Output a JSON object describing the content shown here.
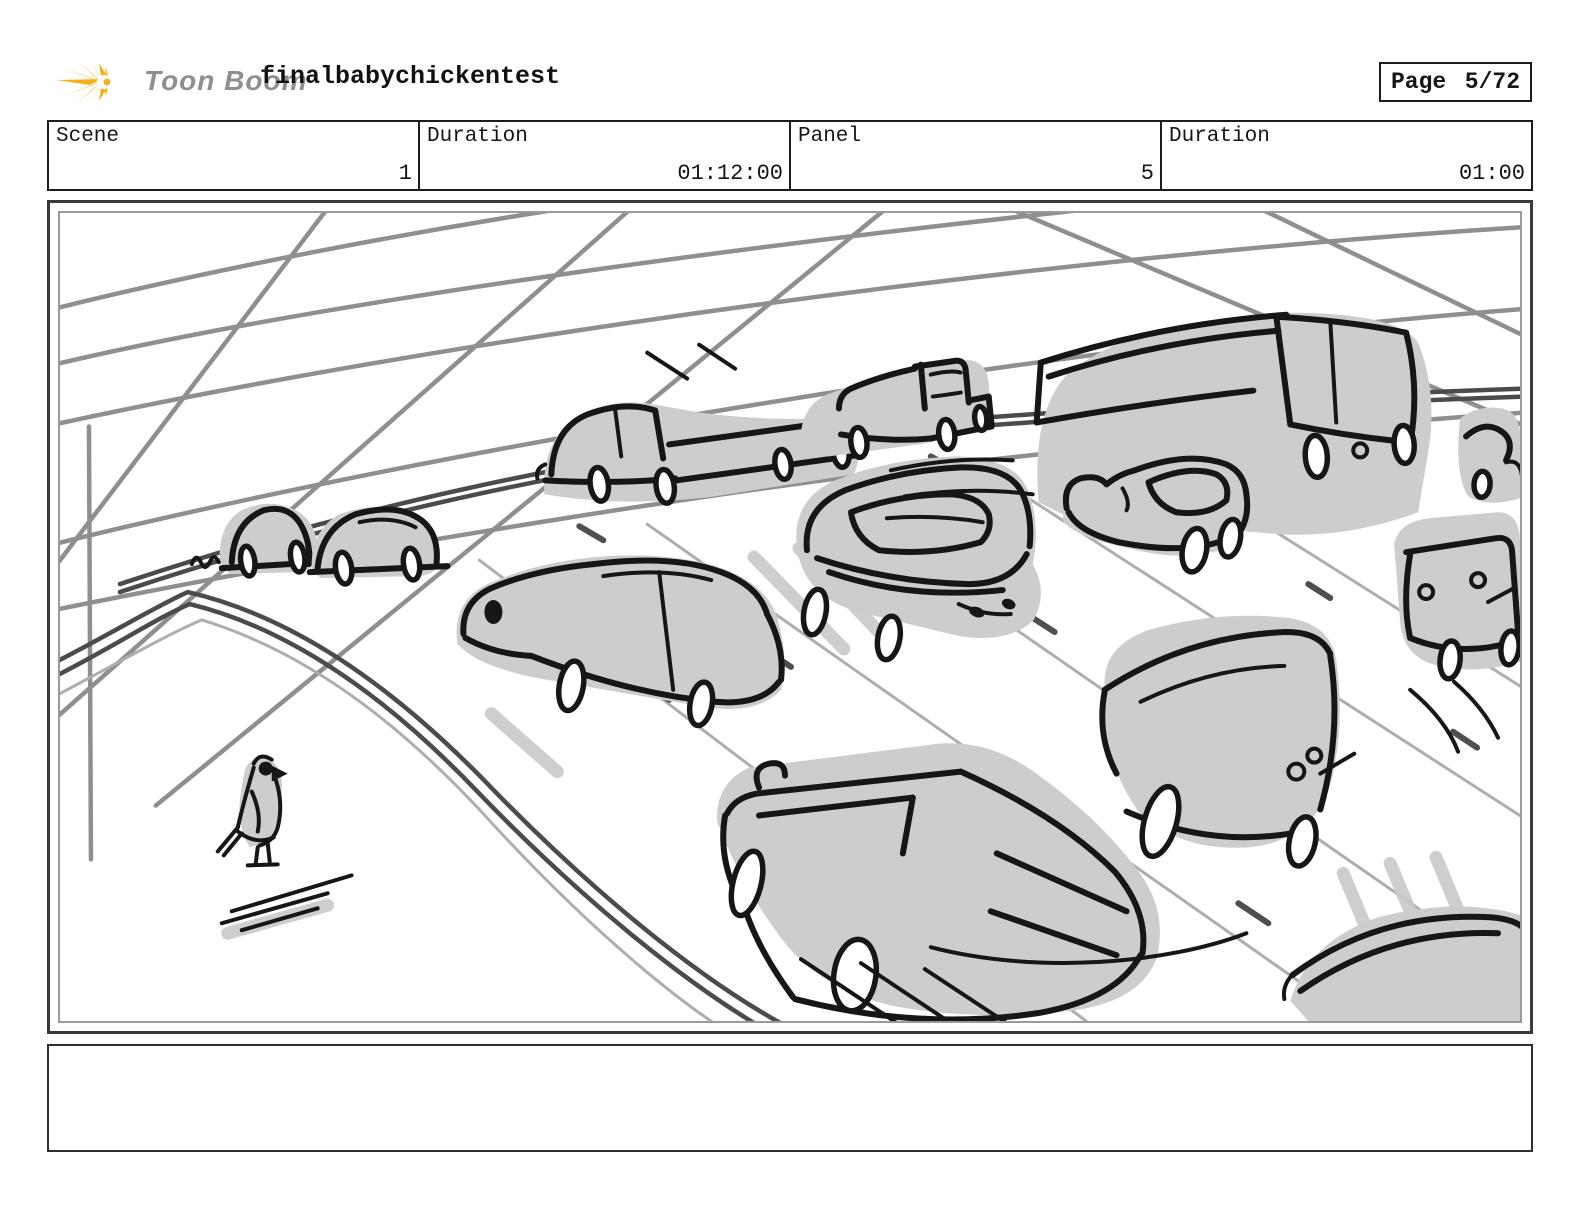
{
  "header": {
    "brand": "Toon Boom",
    "logo_icon": "toonboom-starburst-icon",
    "logo_color": "#f8ae17",
    "brand_text_color": "#8f8f8f",
    "project_title": "finalbabychickentest",
    "page_label": "Page",
    "page_value": "5/72"
  },
  "info_row": {
    "cells": [
      {
        "label": "Scene",
        "value": "1"
      },
      {
        "label": "Duration",
        "value": "01:12:00"
      },
      {
        "label": "Panel",
        "value": "5"
      },
      {
        "label": "Duration",
        "value": "01:00"
      }
    ]
  },
  "panel": {
    "description": "Rough storyboard sketch: heavy traffic on a wide curving road seen from above; many loosely drawn cars and trucks with light gray shadows drive along a guardrail, overhead wires cross the sky, and a small bird stands on the empty sidewalk at lower left.",
    "sketch_colors": {
      "ink": "#161616",
      "shadow": "#cdcdcd",
      "wires": "#8f8f8f",
      "rails": "#4b4b4b"
    }
  },
  "caption": {
    "text": ""
  }
}
